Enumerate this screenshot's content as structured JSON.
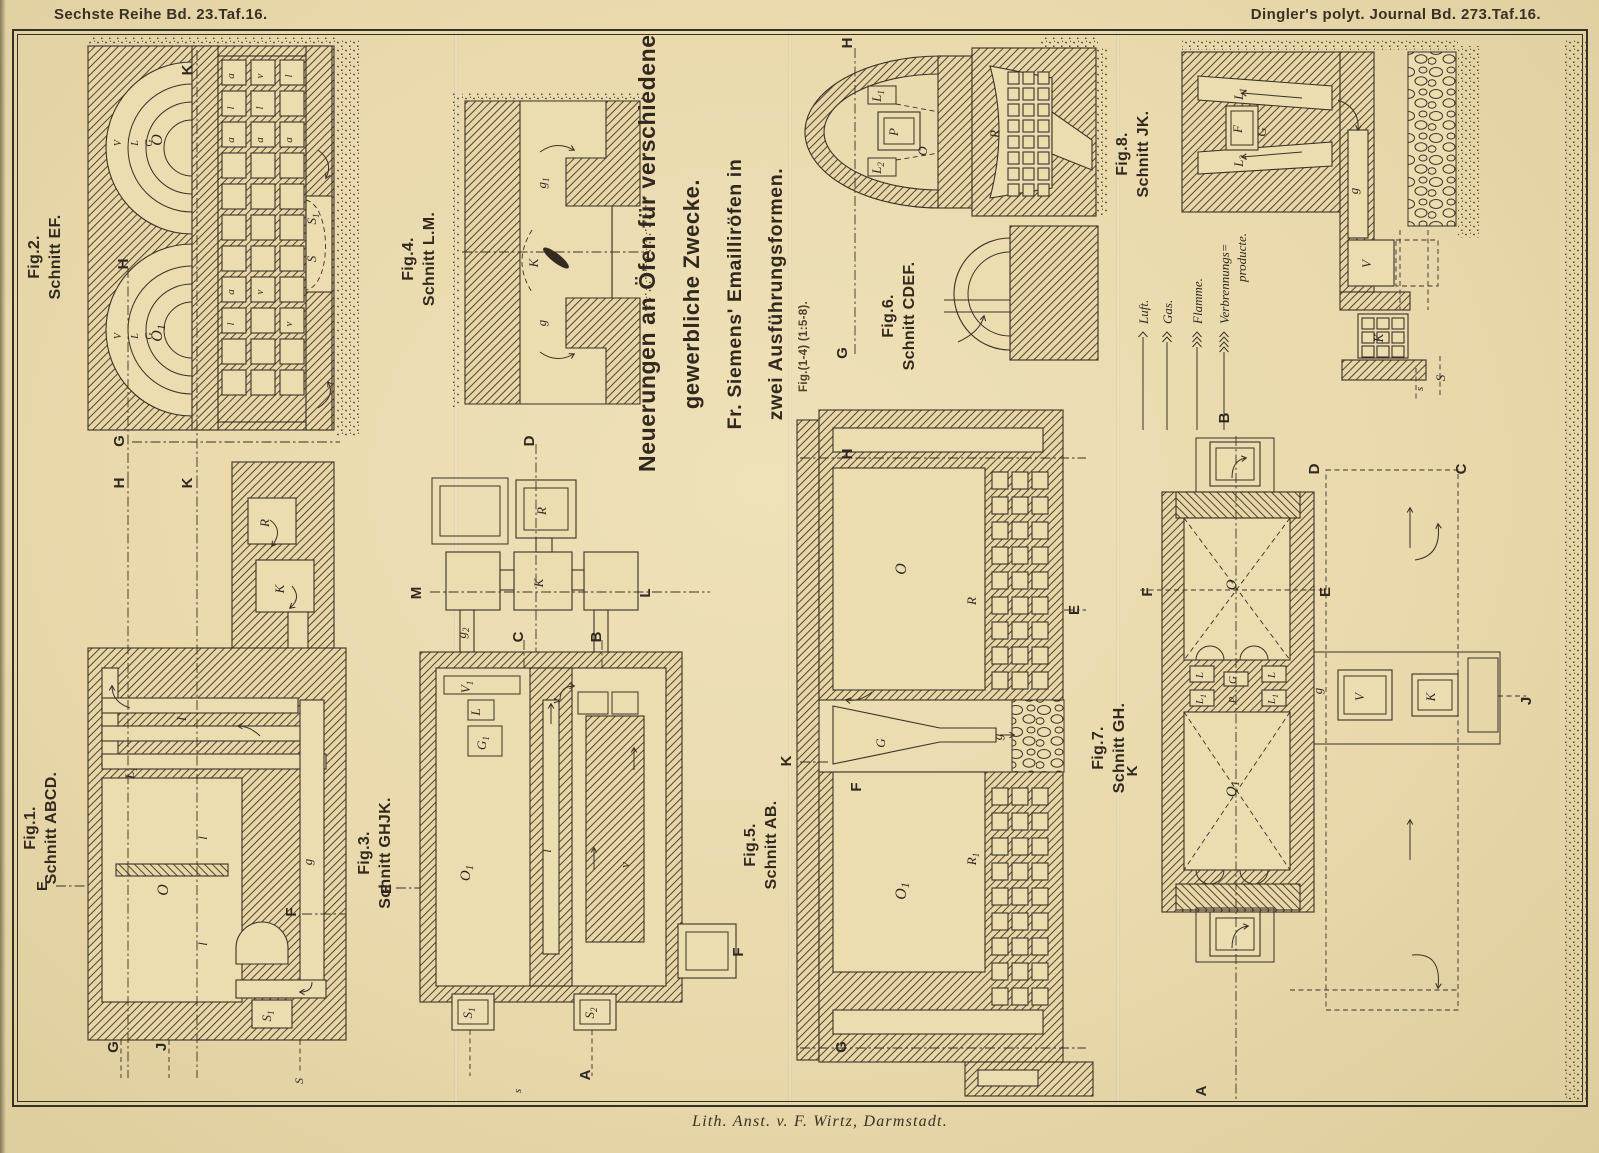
{
  "page": {
    "header_left_parts": [
      "Sechste Reihe Bd.",
      "23",
      ".Taf.",
      "16."
    ],
    "header_right_parts": [
      "Dingler's polyt. Journal Bd.",
      "273",
      ".Taf.",
      "16."
    ],
    "footer": "Lith. Anst. v. F. Wirtz, Darmstadt.",
    "paper_color": "#e9d9ac",
    "ink_color": "#3a3126"
  },
  "title": {
    "lines": [
      "Neuerungen an Öfen für verschiedene",
      "gewerbliche Zwecke.",
      "Fr. Siemens'  Emailliröfen  in",
      "zwei  Ausführungsformen."
    ],
    "note": "Fig.(1-4) (1:5-8)."
  },
  "legend": {
    "arrow_top_y": 332,
    "arrow_bottom_y": 430,
    "items": [
      {
        "label": "Luft.",
        "barbs": 1,
        "x": 1143
      },
      {
        "label": "Gas.",
        "barbs": 2,
        "x": 1167
      },
      {
        "label": "Flamme.",
        "barbs": 3,
        "x": 1197
      },
      {
        "label": "Verbrennungs= producte.",
        "barbs": 4,
        "x": 1224
      }
    ]
  },
  "figures": [
    {
      "id": "fig1",
      "label": "Fig.1.",
      "section": "Schnitt ABCD."
    },
    {
      "id": "fig2",
      "label": "Fig.2.",
      "section": "Schnitt EF."
    },
    {
      "id": "fig3",
      "label": "Fig.3.",
      "section": "Schnitt GHJK."
    },
    {
      "id": "fig4",
      "label": "Fig.4.",
      "section": "Schnitt L.M."
    },
    {
      "id": "fig5",
      "label": "Fig.5.",
      "section": "Schnitt AB."
    },
    {
      "id": "fig6",
      "label": "Fig.6.",
      "section": "Schnitt CDEF."
    },
    {
      "id": "fig7",
      "label": "Fig.7.",
      "section": "Schnitt GH."
    },
    {
      "id": "fig8",
      "label": "Fig.8.",
      "section": "Schnitt JK."
    }
  ],
  "plate_letters": [
    [
      "K",
      192,
      70,
      "s"
    ],
    [
      "H",
      128,
      264,
      "s"
    ],
    [
      "G",
      124,
      441,
      "s"
    ],
    [
      "H",
      124,
      483,
      "s"
    ],
    [
      "K",
      192,
      483,
      "s"
    ],
    [
      "E",
      47,
      886,
      "s"
    ],
    [
      "F",
      296,
      912,
      "s"
    ],
    [
      "G",
      118,
      1047,
      "s"
    ],
    [
      "J",
      166,
      1047,
      "s"
    ],
    [
      "D",
      534,
      441,
      "s"
    ],
    [
      "M",
      421,
      593,
      "s"
    ],
    [
      "L",
      650,
      593,
      "s"
    ],
    [
      "C",
      523,
      637,
      "s"
    ],
    [
      "B",
      601,
      637,
      "s"
    ],
    [
      "E",
      391,
      889,
      "s"
    ],
    [
      "A",
      590,
      1075,
      "s"
    ],
    [
      "F",
      743,
      952,
      "s"
    ],
    [
      "H",
      852,
      454,
      "s"
    ],
    [
      "K",
      791,
      761,
      "s"
    ],
    [
      "G",
      846,
      1047,
      "s"
    ],
    [
      "E",
      1079,
      610,
      "s"
    ],
    [
      "F",
      861,
      787,
      "s"
    ],
    [
      "H",
      852,
      43,
      "s"
    ],
    [
      "G",
      847,
      353,
      "s"
    ],
    [
      "B",
      1229,
      418,
      "s"
    ],
    [
      "F",
      1152,
      592,
      "s"
    ],
    [
      "E",
      1330,
      592,
      "s"
    ],
    [
      "D",
      1319,
      469,
      "s"
    ],
    [
      "C",
      1466,
      469,
      "s"
    ],
    [
      "J",
      1531,
      701,
      "s"
    ],
    [
      "A",
      1206,
      1091,
      "s"
    ],
    [
      "K",
      1137,
      771,
      "s"
    ],
    [
      "O",
      162,
      140,
      "i",
      16
    ],
    [
      "O₁",
      162,
      333,
      "i",
      16
    ],
    [
      "S₁",
      316,
      219,
      "i"
    ],
    [
      "S",
      316,
      259,
      "i"
    ],
    [
      "V",
      121,
      143,
      "i",
      10
    ],
    [
      "L",
      138,
      143,
      "i",
      10
    ],
    [
      "G",
      152,
      143,
      "i",
      10
    ],
    [
      "V",
      121,
      336,
      "i",
      10
    ],
    [
      "L",
      138,
      336,
      "i",
      10
    ],
    [
      "G",
      152,
      336,
      "i",
      10
    ],
    [
      "a",
      234,
      76,
      "i",
      11
    ],
    [
      "l",
      234,
      108,
      "i",
      11
    ],
    [
      "a",
      234,
      140,
      "i",
      11
    ],
    [
      "v",
      263,
      76,
      "i",
      11
    ],
    [
      "l",
      263,
      108,
      "i",
      11
    ],
    [
      "a",
      263,
      140,
      "i",
      11
    ],
    [
      "a",
      234,
      292,
      "i",
      11
    ],
    [
      "l",
      234,
      324,
      "i",
      11
    ],
    [
      "v",
      263,
      292,
      "i",
      11
    ],
    [
      "l",
      292,
      76,
      "i",
      11
    ],
    [
      "v",
      292,
      324,
      "i",
      11
    ],
    [
      "a",
      292,
      140,
      "i",
      11
    ],
    [
      "R",
      269,
      523,
      "i"
    ],
    [
      "K",
      284,
      589,
      "i"
    ],
    [
      "g",
      312,
      862,
      "i"
    ],
    [
      "O",
      168,
      890,
      "i",
      16
    ],
    [
      "l",
      207,
      838,
      "i"
    ],
    [
      "l",
      207,
      944,
      "i"
    ],
    [
      "L₁",
      134,
      773,
      "i"
    ],
    [
      "I",
      186,
      719,
      "i"
    ],
    [
      "S₁",
      271,
      1016,
      "i"
    ],
    [
      "S",
      303,
      1081,
      "i",
      12
    ],
    [
      "g₁",
      546,
      183,
      "i"
    ],
    [
      "g",
      546,
      323,
      "i"
    ],
    [
      "K",
      538,
      263,
      "i"
    ],
    [
      "R",
      546,
      511,
      "i"
    ],
    [
      "K",
      543,
      583,
      "i"
    ],
    [
      "g₂",
      466,
      633,
      "i"
    ],
    [
      "V₁",
      470,
      687,
      "i"
    ],
    [
      "L",
      480,
      712,
      "i"
    ],
    [
      "G₁",
      486,
      743,
      "i"
    ],
    [
      "O₁",
      470,
      873,
      "i",
      15
    ],
    [
      "l",
      551,
      851,
      "i"
    ],
    [
      "v",
      629,
      865,
      "i"
    ],
    [
      "v",
      560,
      701,
      "i"
    ],
    [
      "S₁",
      472,
      1013,
      "i"
    ],
    [
      "S₂",
      594,
      1013,
      "i"
    ],
    [
      "s",
      521,
      1091,
      "i",
      11
    ],
    [
      "O",
      906,
      569,
      "i",
      16
    ],
    [
      "O₁",
      906,
      891,
      "i",
      16
    ],
    [
      "R",
      976,
      601,
      "i"
    ],
    [
      "R₁",
      976,
      859,
      "i"
    ],
    [
      "G",
      885,
      743,
      "i"
    ],
    [
      "g",
      1002,
      737,
      "i"
    ],
    [
      "L₁",
      881,
      96,
      "i"
    ],
    [
      "P",
      898,
      132,
      "i"
    ],
    [
      "O",
      927,
      151,
      "i"
    ],
    [
      "L₂",
      881,
      168,
      "i"
    ],
    [
      "R",
      999,
      134,
      "i"
    ],
    [
      "L₁",
      1243,
      94,
      "i"
    ],
    [
      "F",
      1242,
      129,
      "i"
    ],
    [
      "G",
      1266,
      132,
      "i"
    ],
    [
      "L₂",
      1243,
      161,
      "i"
    ],
    [
      "g",
      1358,
      191,
      "i"
    ],
    [
      "V",
      1371,
      264,
      "i"
    ],
    [
      "K",
      1383,
      338,
      "i"
    ],
    [
      "S",
      1445,
      378,
      "i"
    ],
    [
      "s",
      1423,
      389,
      "i",
      11
    ],
    [
      "O",
      1236,
      585,
      "i",
      15
    ],
    [
      "O₁",
      1236,
      789,
      "i",
      15
    ],
    [
      "L",
      1203,
      675,
      "i",
      11
    ],
    [
      "L₁",
      1203,
      699,
      "i",
      11
    ],
    [
      "G",
      1236,
      680,
      "i",
      11
    ],
    [
      "P",
      1236,
      700,
      "i",
      11
    ],
    [
      "L",
      1275,
      675,
      "i",
      11
    ],
    [
      "L₁",
      1275,
      699,
      "i",
      11
    ],
    [
      "V",
      1364,
      697,
      "i"
    ],
    [
      "K",
      1435,
      697,
      "i"
    ],
    [
      "g",
      1322,
      691,
      "i"
    ]
  ]
}
